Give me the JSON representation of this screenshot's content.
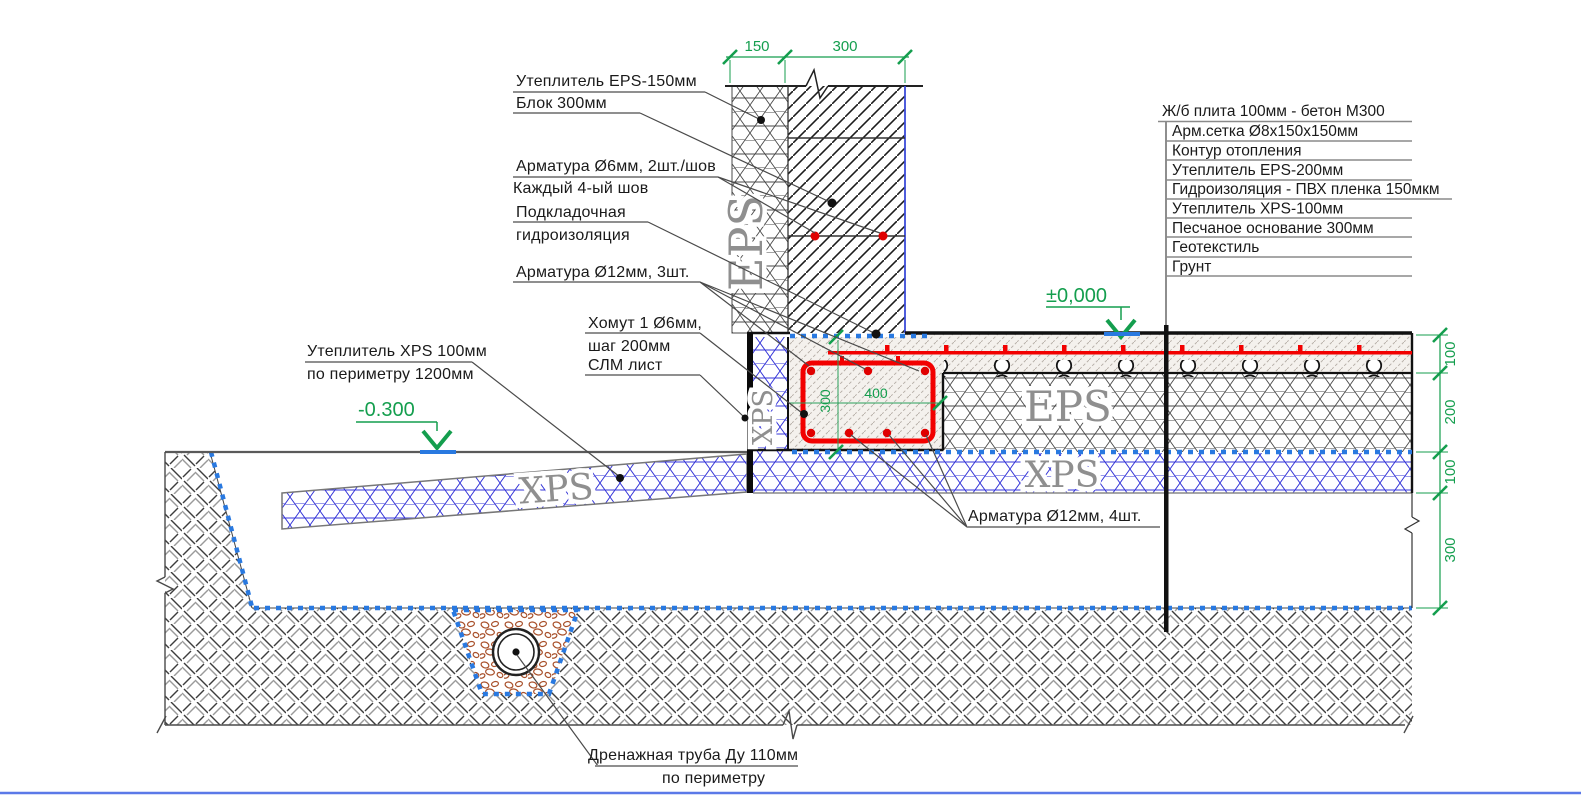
{
  "drawing": {
    "callouts": {
      "eps150": "Утеплитель EPS-150мм",
      "block": "Блок 300мм",
      "rebar6": "Арматура Ø6мм, 2шт./шов",
      "every4": "Каждый 4-ый шов",
      "bed1": "Подкладочная",
      "bed2": "гидроизоляция",
      "rebar12top": "Арматура Ø12мм, 3шт.",
      "stirrup1": "Хомут 1 Ø6мм,",
      "stirrup2": "шаг 200мм",
      "slm": "СЛМ лист",
      "xpsper1": "Утеплитель XPS 100мм",
      "xpsper2": "по периметру 1200мм",
      "rebar12bot": "Арматура Ø12мм, 4шт.",
      "drain1": "Дренажная труба Ду 110мм",
      "drain2": "по периметру"
    },
    "elevations": {
      "zero": "±0,000",
      "minus": "-0.300"
    },
    "dims": {
      "top": [
        "150",
        "300"
      ],
      "right": [
        "100",
        "200",
        "100",
        "300"
      ],
      "beam_w": "400",
      "beam_h": "300"
    },
    "layers_list": {
      "title": "Ж/б плита 100мм - бетон М300",
      "items": [
        "Арм.сетка Ø8х150х150мм",
        "Контур отопления",
        "Утеплитель EPS-200мм",
        "Гидроизоляция - ПВХ пленка 150мкм",
        "Утеплитель XPS-100мм",
        "Песчаное основание 300мм",
        "Геотекстиль",
        "Грунт"
      ]
    },
    "material_tags": {
      "wall_eps": "EPS",
      "floor_eps": "EPS",
      "floor_xps": "XPS",
      "strip_xps": "XPS",
      "wing_xps": "XPS"
    },
    "colors": {
      "dimension_green": "#149e4e",
      "rebar_red": "#f20000",
      "film_blue": "#2979e0",
      "block_edge_blue": "#3b4bd8",
      "gravel_brown": "#a8502a"
    }
  }
}
